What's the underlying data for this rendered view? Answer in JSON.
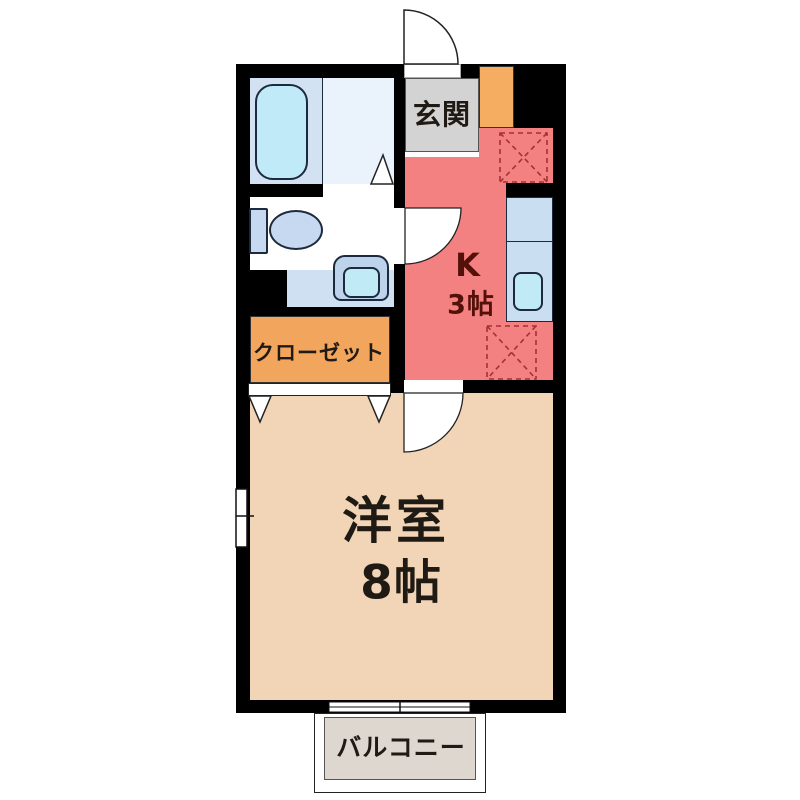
{
  "plan": {
    "type": "floor-plan",
    "rooms": {
      "entrance": {
        "label": "玄関"
      },
      "kitchen": {
        "label": "K",
        "size": "3帖"
      },
      "closet": {
        "label": "クローゼット"
      },
      "western_room": {
        "label": "洋室",
        "size": "8帖"
      },
      "balcony": {
        "label": "バルコニー"
      }
    }
  },
  "colors": {
    "wall": "#000000",
    "kitchen-floor": "#f38181",
    "room-floor": "#f2d4b6",
    "closet-fill": "#f2a55c",
    "entrance-fill": "#d3d3d3",
    "cabinet-fill": "#f5ad62",
    "bath-floor-left": "#d3e2f3",
    "bath-floor-right": "#eaf2fc",
    "bathtub-fill": "#c0eaf8",
    "fixture-fill": "#c6d9f0",
    "basin-fill": "#bdd3ec",
    "wash-floor": "#cfe0f2",
    "counter-fill": "#cadef2",
    "sink-fill": "#c0ebf6",
    "balcony-fill": "#ddd7cf",
    "kitchen-label-color": "#541109",
    "label-color": "#1f1a14",
    "dashed-accent": "#a83030",
    "line-dark": "#1d2a3d"
  }
}
